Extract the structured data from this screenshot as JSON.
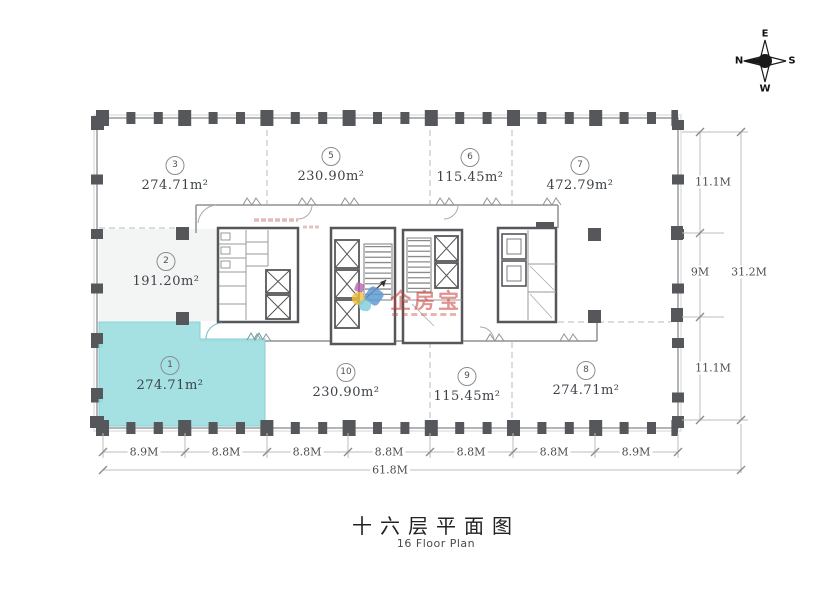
{
  "compass": {
    "top": "E",
    "right": "S",
    "bottom": "W",
    "left": "N"
  },
  "plan": {
    "highlight_color": "#a1e0e1",
    "units": [
      {
        "num": "3",
        "area": "274.71m²"
      },
      {
        "num": "5",
        "area": "230.90m²"
      },
      {
        "num": "6",
        "area": "115.45m²"
      },
      {
        "num": "7",
        "area": "472.79m²"
      },
      {
        "num": "2",
        "area": "191.20m²"
      },
      {
        "num": "1",
        "area": "274.71m²"
      },
      {
        "num": "10",
        "area": "230.90m²"
      },
      {
        "num": "9",
        "area": "115.45m²"
      },
      {
        "num": "8",
        "area": "274.71m²"
      }
    ]
  },
  "dimensions": {
    "right": [
      "11.1M",
      "9M",
      "11.1M"
    ],
    "right_total": "31.2M",
    "bottom": [
      "8.9M",
      "8.8M",
      "8.8M",
      "8.8M",
      "8.8M",
      "8.8M",
      "8.9M"
    ],
    "bottom_total": "61.8M"
  },
  "watermark": {
    "brand": "企房宝"
  },
  "title": {
    "zh": "十六层平面图",
    "en": "16 Floor Plan"
  }
}
